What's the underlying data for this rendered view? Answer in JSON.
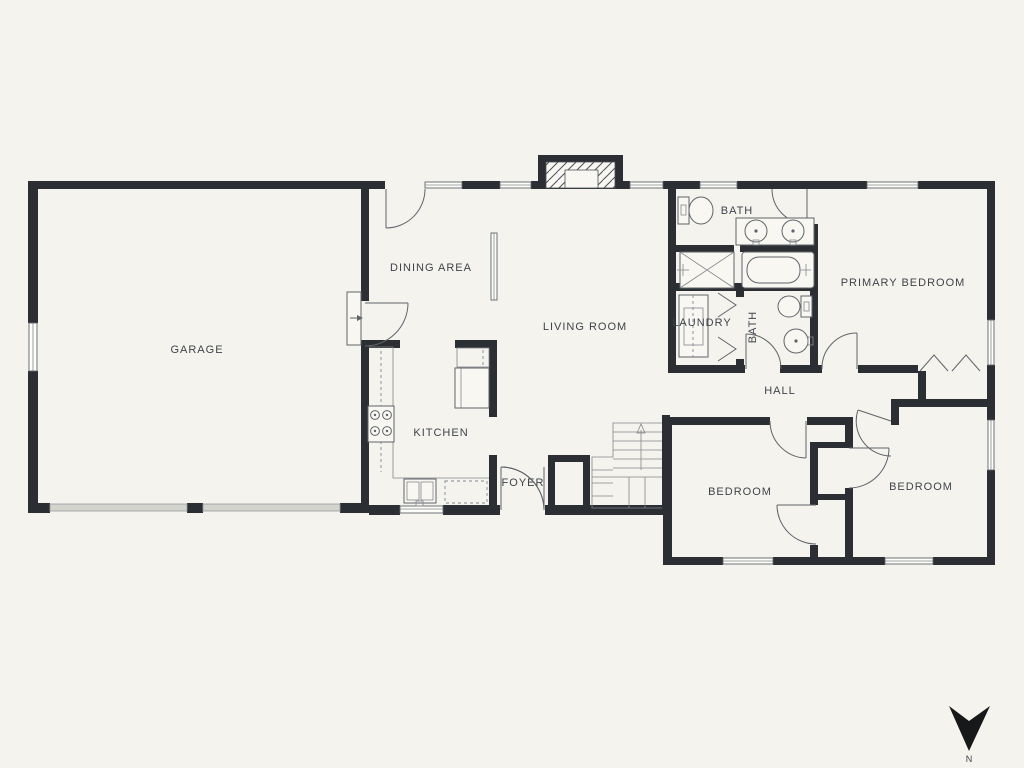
{
  "canvas": {
    "width": 1024,
    "height": 768,
    "background": "#f4f3ed"
  },
  "palette": {
    "wall": "#2b2e33",
    "line": "#60646a",
    "text": "#3f434a",
    "garage_door": "#d4d4cf",
    "north_arrow": "#17181a"
  },
  "rooms": {
    "garage": "GARAGE",
    "dining": "DINING AREA",
    "living": "LIVING ROOM",
    "kitchen": "KITCHEN",
    "foyer": "FOYER",
    "bath1": "BATH",
    "laundry": "LAUNDRY",
    "bath2": "BATH",
    "primary_bedroom": "PRIMARY BEDROOM",
    "hall": "HALL",
    "bedroom1": "BEDROOM",
    "bedroom2": "BEDROOM"
  },
  "compass": {
    "label": "N",
    "direction": "down"
  },
  "fixtures": [
    "toilet",
    "double-vanity-sink",
    "shower",
    "bathtub",
    "washer-dryer",
    "round-sink",
    "stove",
    "kitchen-sink",
    "dishwasher",
    "refrigerator",
    "stairs-up",
    "chimney",
    "water-heater",
    "closet-sliding-doors",
    "bifold-doors",
    "garage-doors"
  ]
}
